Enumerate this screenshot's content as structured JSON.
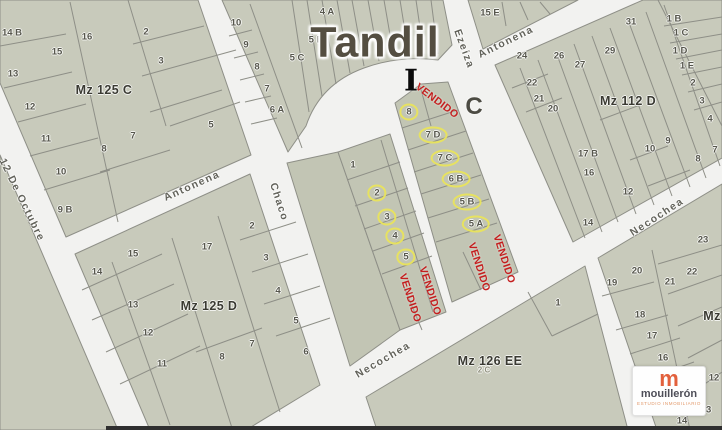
{
  "title": {
    "text": "Tandil"
  },
  "markers": {
    "i": "I",
    "c": "C"
  },
  "sold_text": "VENDIDO",
  "streets": [
    {
      "name": "12 De Octubre",
      "x": 22,
      "y": 200,
      "angle": 64
    },
    {
      "name": "Antonena",
      "x": 192,
      "y": 186,
      "angle": -24
    },
    {
      "name": "Antonena",
      "x": 506,
      "y": 42,
      "angle": -26
    },
    {
      "name": "Chaco",
      "x": 279,
      "y": 202,
      "angle": 72
    },
    {
      "name": "Ezeiza",
      "x": 464,
      "y": 49,
      "angle": 70
    },
    {
      "name": "Necochea",
      "x": 383,
      "y": 360,
      "angle": -30
    },
    {
      "name": "Necochea",
      "x": 657,
      "y": 217,
      "angle": -33
    }
  ],
  "block_labels": [
    {
      "text": "Mz 125 C",
      "x": 104,
      "y": 90
    },
    {
      "text": "Mz 112 D",
      "x": 628,
      "y": 101
    },
    {
      "text": "Mz 125 D",
      "x": 209,
      "y": 306
    },
    {
      "text": "Mz 126 EE",
      "x": 490,
      "y": 361
    },
    {
      "text": "Mz",
      "x": 712,
      "y": 316
    }
  ],
  "sub_labels": [
    {
      "text": "2 C",
      "x": 484,
      "y": 370
    }
  ],
  "lots": [
    {
      "n": "14 B",
      "x": 12,
      "y": 33
    },
    {
      "n": "15",
      "x": 57,
      "y": 52
    },
    {
      "n": "16",
      "x": 87,
      "y": 37
    },
    {
      "n": "2",
      "x": 146,
      "y": 32
    },
    {
      "n": "3",
      "x": 161,
      "y": 61
    },
    {
      "n": "13",
      "x": 13,
      "y": 74
    },
    {
      "n": "12",
      "x": 30,
      "y": 107
    },
    {
      "n": "11",
      "x": 46,
      "y": 139
    },
    {
      "n": "8",
      "x": 104,
      "y": 149
    },
    {
      "n": "7",
      "x": 133,
      "y": 136
    },
    {
      "n": "5",
      "x": 211,
      "y": 125
    },
    {
      "n": "10",
      "x": 61,
      "y": 172
    },
    {
      "n": "9 B",
      "x": 65,
      "y": 210
    },
    {
      "n": "10",
      "x": 236,
      "y": 23
    },
    {
      "n": "9",
      "x": 246,
      "y": 45
    },
    {
      "n": "8",
      "x": 257,
      "y": 67
    },
    {
      "n": "7",
      "x": 267,
      "y": 89
    },
    {
      "n": "6 A",
      "x": 277,
      "y": 110
    },
    {
      "n": "4 A",
      "x": 327,
      "y": 12
    },
    {
      "n": "5 B",
      "x": 316,
      "y": 40
    },
    {
      "n": "5 C",
      "x": 297,
      "y": 58
    },
    {
      "n": "15 E",
      "x": 490,
      "y": 13
    },
    {
      "n": "31",
      "x": 631,
      "y": 22
    },
    {
      "n": "1 B",
      "x": 674,
      "y": 19
    },
    {
      "n": "1 C",
      "x": 681,
      "y": 33
    },
    {
      "n": "1 D",
      "x": 680,
      "y": 51
    },
    {
      "n": "1 E",
      "x": 687,
      "y": 66
    },
    {
      "n": "2",
      "x": 693,
      "y": 83
    },
    {
      "n": "3",
      "x": 702,
      "y": 101
    },
    {
      "n": "4",
      "x": 710,
      "y": 119
    },
    {
      "n": "24",
      "x": 522,
      "y": 56
    },
    {
      "n": "26",
      "x": 559,
      "y": 56
    },
    {
      "n": "27",
      "x": 580,
      "y": 65
    },
    {
      "n": "29",
      "x": 610,
      "y": 51
    },
    {
      "n": "22",
      "x": 532,
      "y": 83
    },
    {
      "n": "21",
      "x": 539,
      "y": 99
    },
    {
      "n": "20",
      "x": 553,
      "y": 109
    },
    {
      "n": "17 B",
      "x": 588,
      "y": 154
    },
    {
      "n": "16",
      "x": 589,
      "y": 173
    },
    {
      "n": "12",
      "x": 628,
      "y": 192
    },
    {
      "n": "10",
      "x": 650,
      "y": 149
    },
    {
      "n": "9",
      "x": 668,
      "y": 141
    },
    {
      "n": "8",
      "x": 698,
      "y": 159
    },
    {
      "n": "7",
      "x": 715,
      "y": 150
    },
    {
      "n": "14",
      "x": 588,
      "y": 223
    },
    {
      "n": "23",
      "x": 703,
      "y": 240
    },
    {
      "n": "22",
      "x": 692,
      "y": 272
    },
    {
      "n": "21",
      "x": 670,
      "y": 282
    },
    {
      "n": "20",
      "x": 637,
      "y": 271
    },
    {
      "n": "19",
      "x": 612,
      "y": 283
    },
    {
      "n": "18",
      "x": 640,
      "y": 315
    },
    {
      "n": "17",
      "x": 652,
      "y": 336
    },
    {
      "n": "16",
      "x": 663,
      "y": 358
    },
    {
      "n": "12",
      "x": 714,
      "y": 378
    },
    {
      "n": "13",
      "x": 706,
      "y": 410
    },
    {
      "n": "14",
      "x": 682,
      "y": 421
    },
    {
      "n": "1",
      "x": 558,
      "y": 303
    },
    {
      "n": "14",
      "x": 97,
      "y": 272
    },
    {
      "n": "15",
      "x": 133,
      "y": 254
    },
    {
      "n": "13",
      "x": 133,
      "y": 305
    },
    {
      "n": "12",
      "x": 148,
      "y": 333
    },
    {
      "n": "11",
      "x": 162,
      "y": 364
    },
    {
      "n": "17",
      "x": 207,
      "y": 247
    },
    {
      "n": "2",
      "x": 252,
      "y": 226
    },
    {
      "n": "3",
      "x": 266,
      "y": 258
    },
    {
      "n": "4",
      "x": 278,
      "y": 291
    },
    {
      "n": "5",
      "x": 296,
      "y": 321
    },
    {
      "n": "7",
      "x": 252,
      "y": 344
    },
    {
      "n": "8",
      "x": 222,
      "y": 357
    },
    {
      "n": "6",
      "x": 306,
      "y": 352
    },
    {
      "n": "1",
      "x": 353,
      "y": 165
    },
    {
      "n": "2",
      "x": 377,
      "y": 193,
      "c": true
    },
    {
      "n": "3",
      "x": 387,
      "y": 217,
      "c": true
    },
    {
      "n": "4",
      "x": 395,
      "y": 236,
      "c": true
    },
    {
      "n": "5",
      "x": 406,
      "y": 257,
      "c": true
    },
    {
      "n": "8",
      "x": 409,
      "y": 112,
      "c": true
    },
    {
      "n": "7 D",
      "x": 433,
      "y": 135,
      "c": true
    },
    {
      "n": "7 C",
      "x": 445,
      "y": 158,
      "c": true
    },
    {
      "n": "6 B",
      "x": 456,
      "y": 179,
      "c": true
    },
    {
      "n": "5 B",
      "x": 467,
      "y": 202,
      "c": true
    },
    {
      "n": "5 A",
      "x": 476,
      "y": 224,
      "c": true
    }
  ],
  "sold": [
    {
      "x": 437,
      "y": 101,
      "angle": 37
    },
    {
      "x": 410,
      "y": 298,
      "angle": 72
    },
    {
      "x": 430,
      "y": 291,
      "angle": 72
    },
    {
      "x": 479,
      "y": 267,
      "angle": 72
    },
    {
      "x": 504,
      "y": 259,
      "angle": 72
    }
  ],
  "logo": {
    "monogram": "m",
    "name": "mouillerón",
    "tagline": "estudio inmobiliario"
  },
  "colors": {
    "street": "#f2f2f0",
    "block": "#c8cabb",
    "block_dark": "#c2c5b4",
    "line": "#8e8f87",
    "sold": "#c41f1f",
    "circle": "#e9e45c",
    "title": "#544e41",
    "label": "#56564c",
    "block_label": "#3a3a32",
    "marker": "#0b0b0b",
    "logo_orange": "#e2603c"
  }
}
